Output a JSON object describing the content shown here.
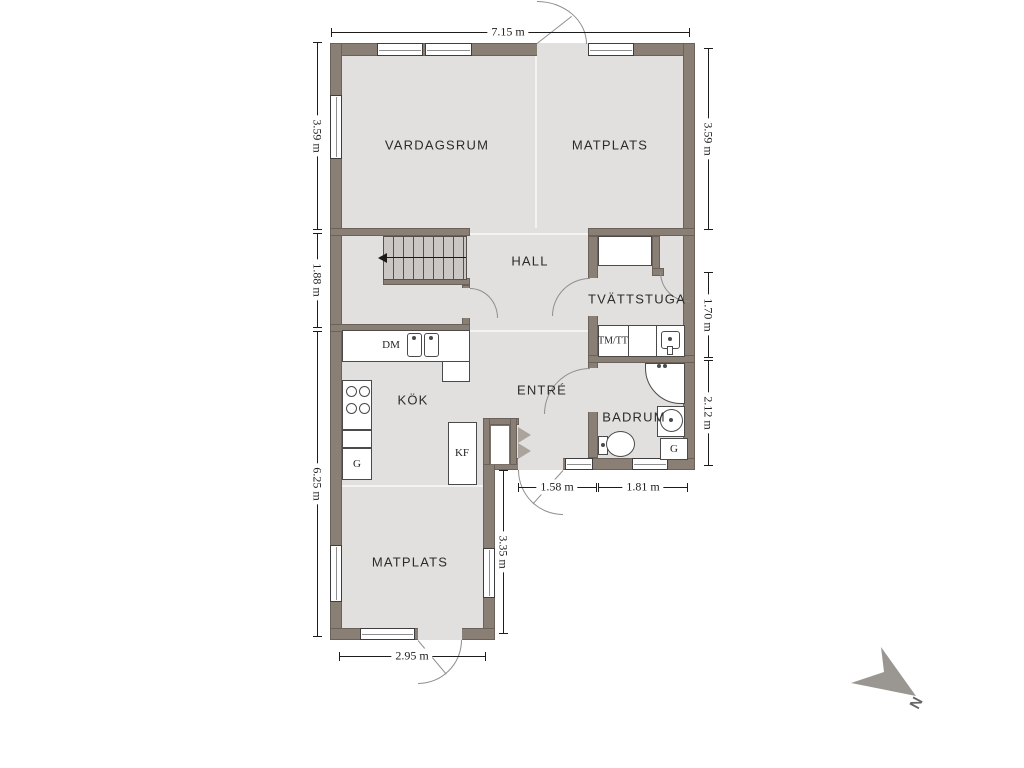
{
  "floorplan": {
    "rooms": {
      "vardagsrum": "VARDAGSRUM",
      "matplats_upper": "MATPLATS",
      "hall": "HALL",
      "tvattstuga": "TVÄTTSTUGA",
      "kok": "KÖK",
      "entre": "ENTRÉ",
      "badrum": "BADRUM",
      "matplats_lower": "MATPLATS"
    },
    "fixtures": {
      "dishwasher": "DM",
      "washer_dryer": "TM/TT",
      "fridge_freezer": "KF",
      "wardrobe_kitchen": "G",
      "wardrobe_bathroom": "G"
    },
    "dimensions": {
      "top_width": "7.15 m",
      "left_upper": "3.59 m",
      "left_middle": "1.88 m",
      "left_lower": "6.25 m",
      "right_upper": "3.59 m",
      "right_middle": "1.70 m",
      "right_lower": "2.12 m",
      "entre_width": "1.58 m",
      "badrum_width": "1.81 m",
      "wing_height": "3.35 m",
      "wing_width": "2.95 m"
    },
    "compass": {
      "north_label": "N"
    },
    "colors": {
      "wall": "#8a7f75",
      "floor": "#e1e0de",
      "stairs": "#c9c6c3",
      "fixture_outline": "#4a4a4a",
      "dimension_text": "#1c1c1c",
      "compass_arrow": "#9a9792",
      "room_label": "#2b2b2b"
    }
  }
}
